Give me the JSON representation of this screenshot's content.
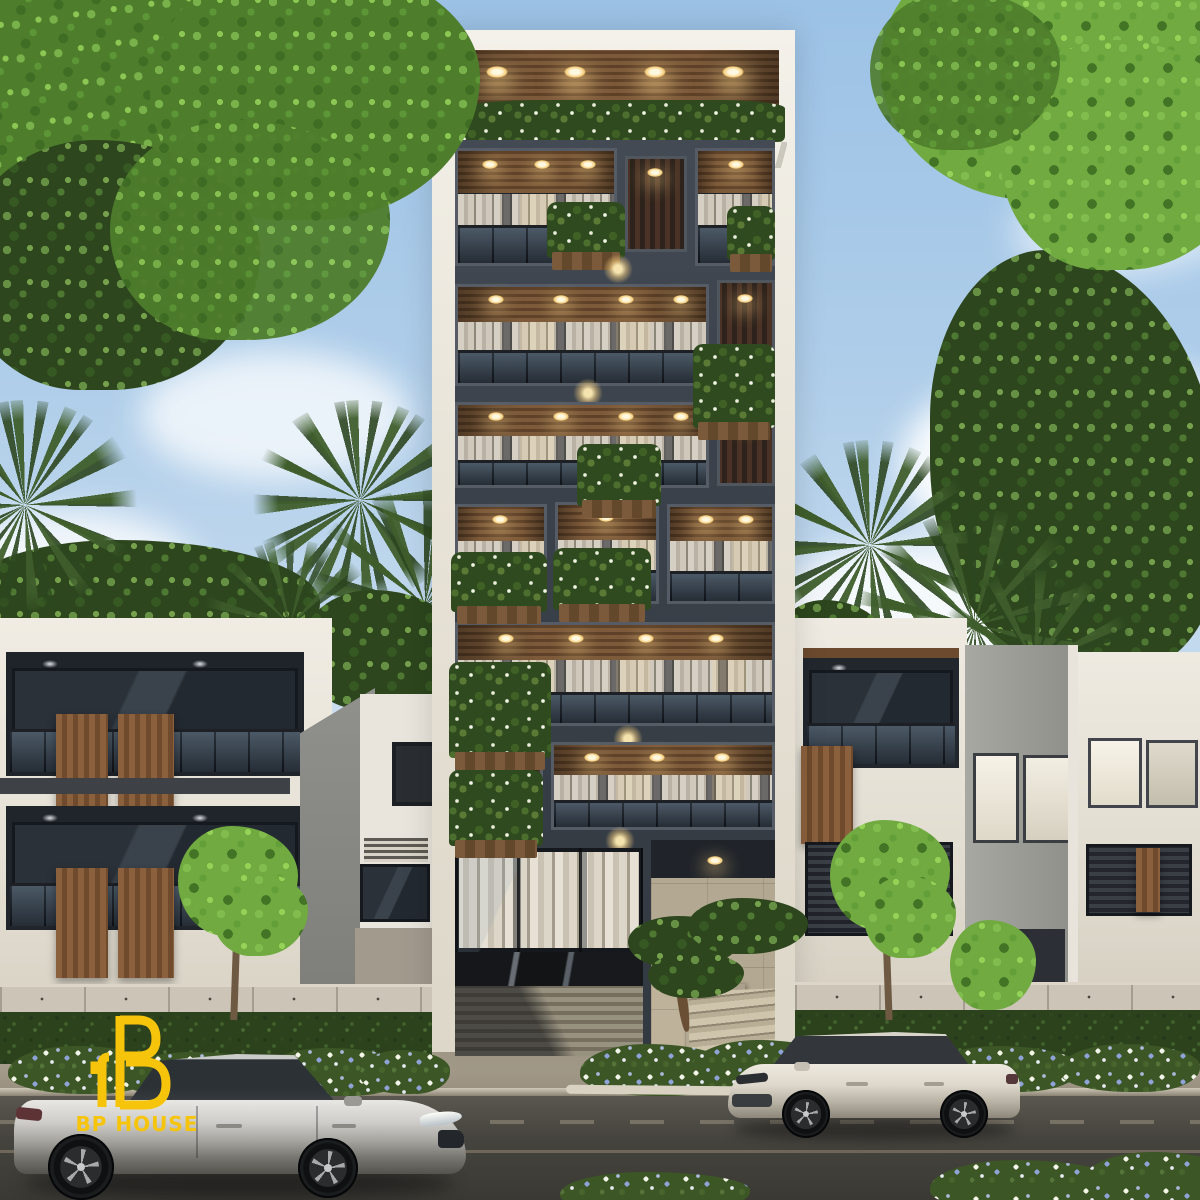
{
  "scene": {
    "kind": "3d-architectural-exterior-render",
    "description": "Narrow modern apartment tower with warm-lit wood balconies and planter boxes, flanked by white townhouses, street with parked silver sedan and cream hatchback, trees and flower beds",
    "branding": {
      "logo_text": "BP HOUSE",
      "logo_color": "#F6C50B",
      "logo_icon": "bp-house-building-monogram"
    },
    "tower": {
      "residential_floors": 6,
      "rooftop_pergola_lights": 4,
      "features": [
        "rooftop pergola with wood slats",
        "glass balustrades",
        "white curtains",
        "planter boxes with white flowers",
        "ground-floor roller garage door",
        "black marble band",
        "stone entrance staircase",
        "bonsai and flower bed"
      ]
    },
    "neighbors": {
      "left": "white townhouse with wood shutter panels and glass balconies",
      "right": "white and grey townhouses with lit windows"
    },
    "street": {
      "cars": [
        {
          "type": "silver sedan",
          "facing": "right"
        },
        {
          "type": "cream hatchback",
          "facing": "left"
        }
      ],
      "landscaping": [
        "clipped hedges",
        "white and blue flower beds",
        "street trees",
        "palm trees"
      ]
    },
    "palette": {
      "sky_top": "#9CC2E6",
      "sky_horizon": "#DCE9F4",
      "cloud": "#FFFFFF",
      "foliage_bright": "#7FB34A",
      "foliage_dark": "#30491F",
      "facade_light": "#EAE6DD",
      "facade_dark": "#3C434C",
      "wood": "#7A5838",
      "warm_light": "#FFE3A1",
      "stone": "#B5AA96",
      "road": "#45443F",
      "sidewalk": "#A99F8E",
      "car_silver": "#C4C2BE",
      "car_cream": "#E2DDD2",
      "flowers_blue": "#8FA3D8",
      "flowers_white": "#F3F6EA"
    }
  }
}
